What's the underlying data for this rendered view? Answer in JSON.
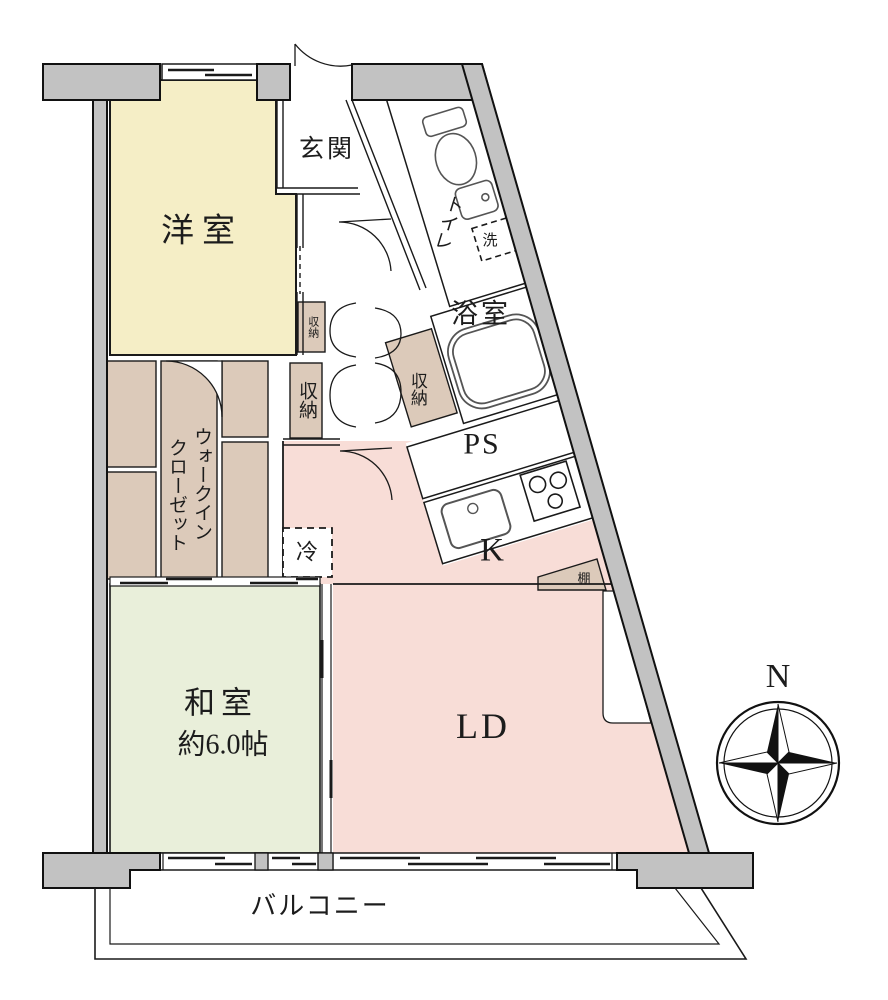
{
  "labels": {
    "western_room": "洋室",
    "entrance": "玄関",
    "toilet": "トイレ",
    "wash": "洗",
    "bathroom": "浴室",
    "storage": "収納",
    "pipe_space": "PS",
    "kitchen": "K",
    "fridge": "冷",
    "shelf": "棚",
    "wic_line1": "ウォークイン",
    "wic_line2": "クローゼット",
    "japanese_room": "和室",
    "japanese_room_size": "約6.0帖",
    "living_dining": "LD",
    "balcony": "バルコニー",
    "north": "N"
  },
  "colors": {
    "wall": "#c2c2c2",
    "western_room": "#f5eec6",
    "closet": "#dccaba",
    "kitchen_ld": "#f8ddd7",
    "japanese_room": "#e9efda",
    "line": "#1a1a1a"
  }
}
